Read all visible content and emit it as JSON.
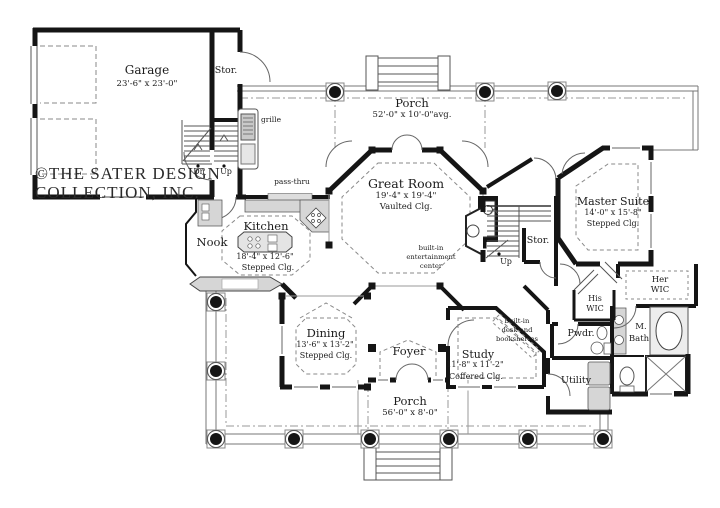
{
  "colors": {
    "wall": "#151515",
    "thin_line": "#777777",
    "gray_fill": "#d6d6d6",
    "dash": "#8a8a8a",
    "text": "#1c1c1c"
  },
  "copyright": {
    "line1": "©THE SATER DESIGN",
    "line2": "COLLECTION, INC."
  },
  "rooms": {
    "garage": {
      "name": "Garage",
      "dims": "23'-6\" x 23'-0\""
    },
    "stor_garage": {
      "name": "Stor."
    },
    "porch_top": {
      "name": "Porch",
      "dims": "52'-0\" x 10'-0\"avg."
    },
    "great_room": {
      "name": "Great Room",
      "dims": "19'-4\" x 19'-4\"",
      "ceiling": "Vaulted Clg."
    },
    "kitchen": {
      "name": "Kitchen",
      "dims": "18'-4\" x 12'-6\"",
      "ceiling": "Stepped Clg."
    },
    "nook": {
      "name": "Nook"
    },
    "master_suite": {
      "name": "Master Suite",
      "dims": "14'-0\" x 15'-8\"",
      "ceiling": "Stepped Clg."
    },
    "stor_stairs": {
      "name": "Stor."
    },
    "dining": {
      "name": "Dining",
      "dims": "13'-6\" x 13'-2\"",
      "ceiling": "Stepped Clg."
    },
    "foyer": {
      "name": "Foyer"
    },
    "study": {
      "name": "Study",
      "dims": "11'-8\" x 11'-2\"",
      "ceiling": "Coffered Clg."
    },
    "porch_bottom": {
      "name": "Porch",
      "dims": "56'-0\" x 8'-0\""
    },
    "powder": {
      "name": "Pwdr."
    },
    "utility": {
      "name": "Utility"
    },
    "his_wic": {
      "line1": "His",
      "line2": "WIC"
    },
    "her_wic": {
      "line1": "Her",
      "line2": "WIC"
    },
    "master_bath": {
      "line1": "M.",
      "line2": "Bath"
    }
  },
  "annotations": {
    "grille": "grille",
    "pass_thru": "pass-thru",
    "dn": "Dn",
    "up_garage": "Up",
    "up_stairs": "Up",
    "entertainment": {
      "line1": "built-in",
      "line2": "entertainment",
      "line3": "center"
    },
    "desk": {
      "line1": "built-in",
      "line2": "desk and",
      "line3": "bookshelves"
    }
  }
}
